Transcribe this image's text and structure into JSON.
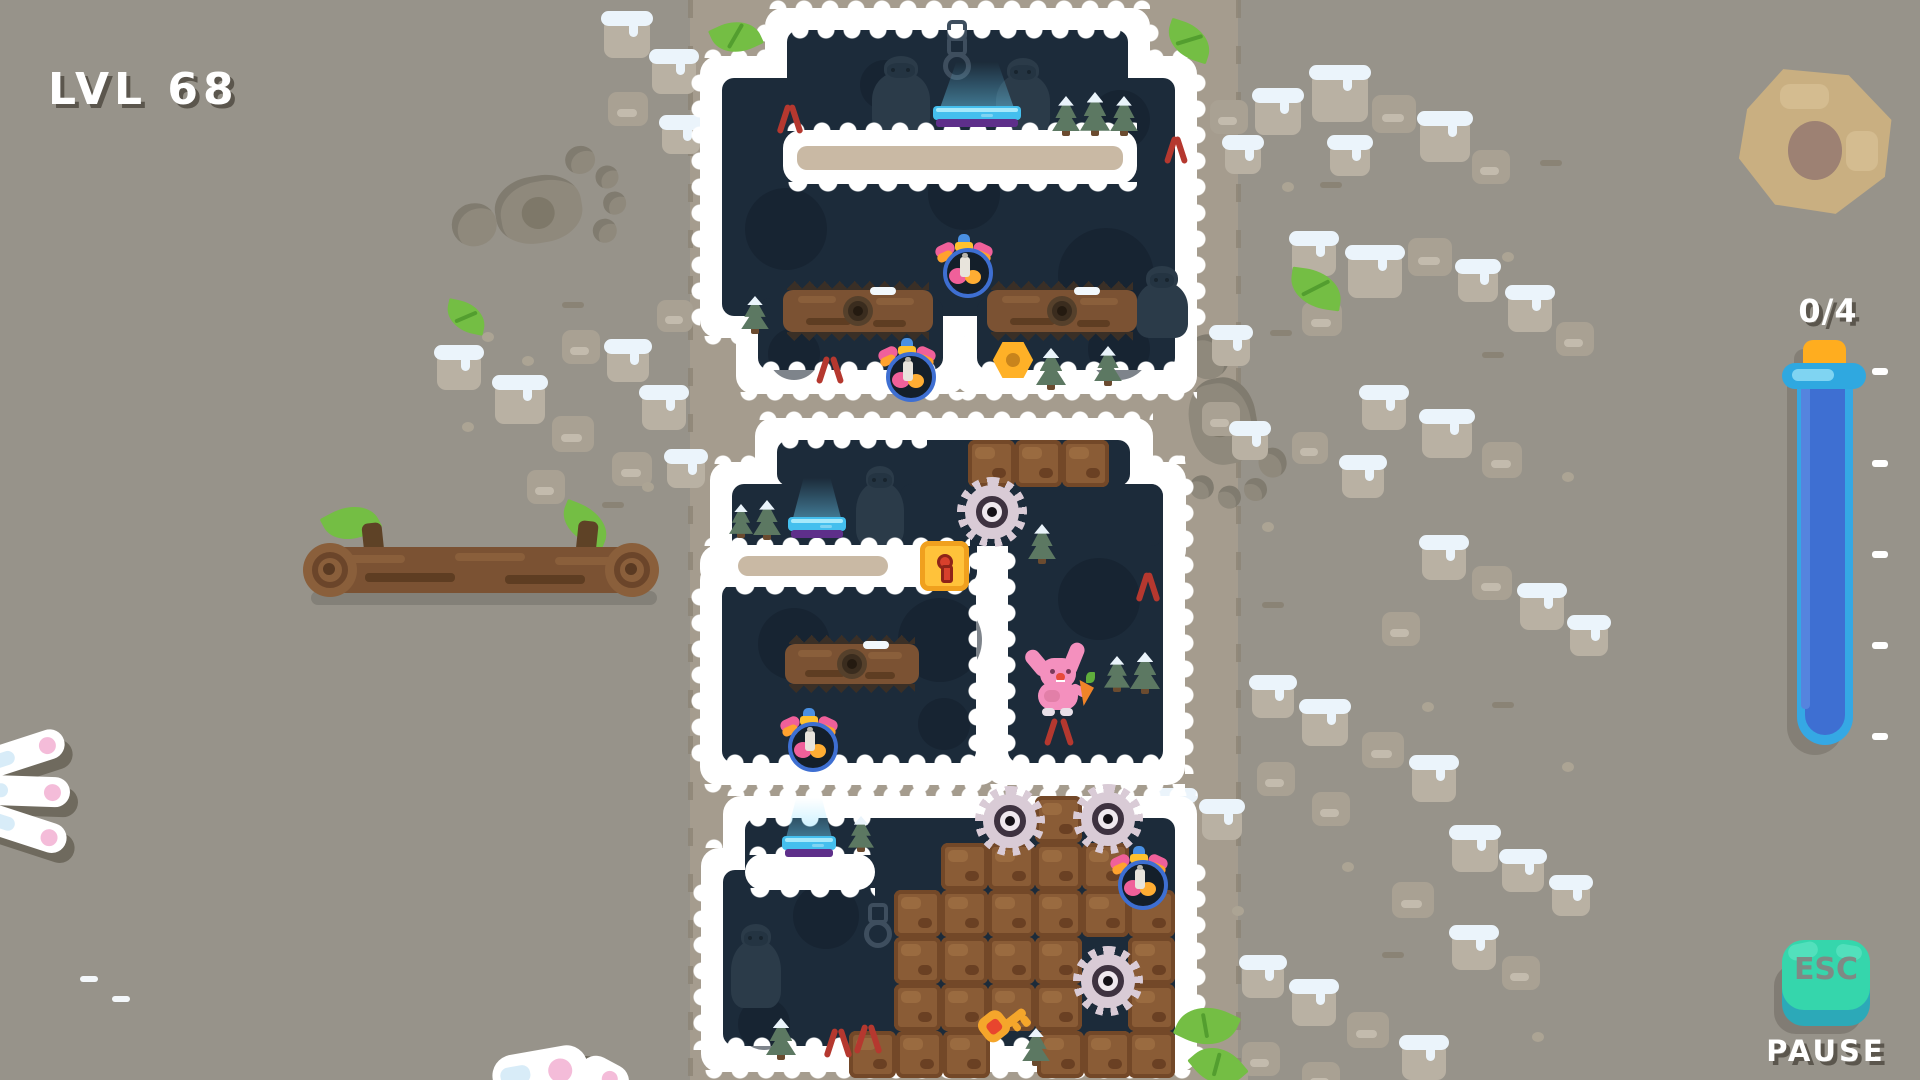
{
  "hud": {
    "level_label": "LVL 68",
    "counter": "0/4",
    "esc_label": "ESC",
    "pause_label": "PAUSE",
    "tube_ticks": [
      368,
      460,
      551,
      642,
      733
    ]
  },
  "colors": {
    "background": "#97938a",
    "path": "#a59c8e",
    "cave": "#1c2b3a",
    "snow_border": "#ffffff",
    "tube_fill": "#3e6fd2",
    "tube_glass": "#35a8e4",
    "tube_cap": "#ffad1f",
    "esc_button": "#35d6ac",
    "esc_side": "#2ca9b8",
    "crate": "#8a5c36",
    "saw": "#d9cbd6",
    "lock": "#ffc23a",
    "key": "#f5a62b",
    "bunny": "#f490be",
    "carrot": "#f08428",
    "leaf": "#74be44",
    "pad": "#44bfee",
    "pad_base": "#5e2f8a"
  },
  "scene": {
    "path": {
      "x": 690,
      "w": 548
    },
    "white_pieces": [
      [
        765,
        8,
        385,
        144
      ],
      [
        700,
        56,
        497,
        282
      ],
      [
        736,
        276,
        229,
        118
      ],
      [
        955,
        276,
        242,
        118
      ],
      [
        755,
        418,
        398,
        90
      ],
      [
        710,
        462,
        289,
        146
      ],
      [
        700,
        562,
        298,
        223
      ],
      [
        986,
        462,
        199,
        323
      ],
      [
        878,
        462,
        308,
        106
      ],
      [
        723,
        796,
        474,
        136
      ],
      [
        701,
        848,
        496,
        224
      ]
    ],
    "navy_pieces": [
      [
        787,
        30,
        341,
        100
      ],
      [
        722,
        78,
        453,
        238
      ],
      [
        758,
        298,
        185,
        72
      ],
      [
        977,
        298,
        198,
        72
      ],
      [
        777,
        440,
        353,
        46
      ],
      [
        732,
        484,
        245,
        100
      ],
      [
        722,
        584,
        254,
        179
      ],
      [
        1008,
        484,
        155,
        279
      ],
      [
        900,
        484,
        263,
        62
      ],
      [
        745,
        818,
        430,
        92
      ],
      [
        723,
        870,
        452,
        176
      ]
    ],
    "outer_bumps": [
      [
        765,
        -4,
        385,
        "top"
      ],
      [
        700,
        45,
        497,
        "top"
      ],
      [
        736,
        392,
        229,
        "bottom"
      ],
      [
        955,
        392,
        242,
        "bottom"
      ],
      [
        700,
        336,
        497,
        "bottom"
      ],
      [
        688,
        70,
        260,
        "left"
      ],
      [
        1197,
        70,
        260,
        "right"
      ],
      [
        753,
        20,
        120,
        "left"
      ],
      [
        1150,
        20,
        120,
        "right"
      ],
      [
        755,
        407,
        398,
        "top"
      ],
      [
        710,
        451,
        289,
        "top"
      ],
      [
        700,
        550,
        298,
        "top"
      ],
      [
        986,
        451,
        199,
        "top"
      ],
      [
        878,
        451,
        308,
        "top"
      ],
      [
        700,
        784,
        298,
        "bottom"
      ],
      [
        986,
        784,
        199,
        "bottom"
      ],
      [
        688,
        584,
        180,
        "left"
      ],
      [
        1185,
        474,
        300,
        "right"
      ],
      [
        723,
        783,
        474,
        "top"
      ],
      [
        701,
        835,
        496,
        "top"
      ],
      [
        701,
        1070,
        496,
        "bottom"
      ],
      [
        690,
        880,
        170,
        "left"
      ],
      [
        1197,
        860,
        200,
        "right"
      ]
    ],
    "inner_bumps": [
      [
        787,
        30,
        341,
        "bottom"
      ],
      [
        758,
        357,
        185,
        "top"
      ],
      [
        977,
        357,
        198,
        "top"
      ],
      [
        777,
        440,
        150,
        "bottom"
      ],
      [
        722,
        750,
        254,
        "top"
      ],
      [
        1008,
        750,
        155,
        "top"
      ],
      [
        965,
        548,
        215,
        "left"
      ],
      [
        1007,
        548,
        215,
        "right"
      ],
      [
        745,
        818,
        130,
        "bottom"
      ],
      [
        723,
        1033,
        452,
        "top"
      ]
    ],
    "platforms": [
      {
        "x": 783,
        "y": 130,
        "w": 354,
        "h": 54,
        "core": [
          797,
          146,
          326,
          24
        ]
      },
      {
        "x": 700,
        "y": 545,
        "w": 270,
        "h": 42,
        "core": [
          738,
          556,
          150,
          20
        ]
      },
      {
        "x": 745,
        "y": 854,
        "w": 130,
        "h": 36,
        "core": null
      }
    ],
    "platform_bumps": [
      [
        783,
        118,
        354,
        "top"
      ],
      [
        783,
        182,
        354,
        "drip"
      ],
      [
        700,
        533,
        270,
        "top"
      ],
      [
        700,
        585,
        270,
        "drip"
      ],
      [
        745,
        842,
        130,
        "top"
      ],
      [
        745,
        888,
        130,
        "drip"
      ]
    ],
    "blobs": [
      [
        745,
        188,
        82
      ],
      [
        928,
        158,
        72
      ],
      [
        1058,
        228,
        96
      ],
      [
        768,
        328,
        52
      ],
      [
        1088,
        318,
        62
      ],
      [
        758,
        608,
        72
      ],
      [
        898,
        598,
        84
      ],
      [
        1058,
        558,
        82
      ],
      [
        918,
        698,
        52
      ],
      [
        793,
        883,
        66
      ],
      [
        738,
        998,
        52
      ],
      [
        860,
        60,
        50
      ],
      [
        1090,
        90,
        60
      ]
    ],
    "yetis": [
      [
        872,
        56,
        58,
        78
      ],
      [
        996,
        58,
        54,
        76
      ],
      [
        1136,
        266,
        52,
        72
      ],
      [
        856,
        466,
        48,
        80
      ],
      [
        731,
        924,
        50,
        84
      ]
    ],
    "chains": [
      [
        947,
        20,
        36
      ],
      [
        868,
        903,
        28
      ]
    ],
    "pads": [
      [
        933,
        106,
        88
      ],
      [
        788,
        517,
        58
      ],
      [
        782,
        836,
        54
      ]
    ],
    "glows": [
      [
        940,
        62,
        74,
        46
      ],
      [
        793,
        478,
        48,
        40
      ],
      [
        786,
        798,
        46,
        40
      ]
    ],
    "spike_logs": [
      [
        783,
        290,
        150,
        42
      ],
      [
        987,
        290,
        150,
        42
      ],
      [
        785,
        644,
        134,
        40
      ]
    ],
    "crates": [
      [
        968,
        440
      ],
      [
        1015,
        440
      ],
      [
        1062,
        440
      ],
      [
        1035,
        796
      ],
      [
        941,
        843
      ],
      [
        988,
        843
      ],
      [
        1035,
        843
      ],
      [
        1082,
        843
      ],
      [
        894,
        890
      ],
      [
        941,
        890
      ],
      [
        988,
        890
      ],
      [
        1035,
        890
      ],
      [
        1082,
        890
      ],
      [
        1128,
        890
      ],
      [
        894,
        937
      ],
      [
        941,
        937
      ],
      [
        988,
        937
      ],
      [
        1035,
        937
      ],
      [
        1128,
        937
      ],
      [
        894,
        984
      ],
      [
        941,
        984
      ],
      [
        988,
        984
      ],
      [
        1035,
        984
      ],
      [
        1128,
        984
      ],
      [
        849,
        1031
      ],
      [
        896,
        1031
      ],
      [
        943,
        1031
      ],
      [
        1037,
        1031
      ],
      [
        1084,
        1031
      ],
      [
        1128,
        1031
      ]
    ],
    "saws": [
      [
        992,
        512,
        27
      ],
      [
        1010,
        821,
        27
      ],
      [
        1108,
        819,
        27
      ],
      [
        1108,
        981,
        27
      ]
    ],
    "lock": [
      920,
      541,
      49,
      50
    ],
    "key": [
      983,
      1003,
      -38
    ],
    "nut": [
      992,
      340
    ],
    "potions": [
      [
        941,
        234
      ],
      [
        884,
        338
      ],
      [
        786,
        708
      ],
      [
        1116,
        846
      ]
    ],
    "bunny": [
      1026,
      650
    ],
    "pines": [
      [
        1052,
        96,
        28,
        40
      ],
      [
        1080,
        92,
        30,
        44
      ],
      [
        1110,
        96,
        28,
        40
      ],
      [
        741,
        296,
        28,
        38
      ],
      [
        1036,
        348,
        30,
        42
      ],
      [
        1094,
        346,
        28,
        40
      ],
      [
        729,
        504,
        24,
        34
      ],
      [
        753,
        500,
        28,
        40
      ],
      [
        1104,
        656,
        26,
        36
      ],
      [
        1130,
        652,
        30,
        42
      ],
      [
        1028,
        524,
        28,
        40
      ],
      [
        848,
        816,
        26,
        36
      ],
      [
        766,
        1018,
        30,
        42
      ],
      [
        1022,
        1028,
        28,
        38
      ]
    ],
    "claws": [
      [
        779,
        104,
        22,
        30
      ],
      [
        1166,
        136,
        20,
        28
      ],
      [
        818,
        356,
        24,
        28
      ],
      [
        1046,
        718,
        26,
        28
      ],
      [
        1138,
        572,
        20,
        30
      ],
      [
        826,
        1028,
        24,
        30
      ],
      [
        856,
        1024,
        24,
        30
      ]
    ],
    "leaves": [
      [
        713,
        20,
        46,
        34,
        -25
      ],
      [
        1166,
        24,
        46,
        34,
        18
      ],
      [
        1290,
        270,
        52,
        38,
        8
      ],
      [
        1186,
        998,
        42,
        56,
        -65
      ],
      [
        1198,
        1042,
        40,
        48,
        -40
      ],
      [
        446,
        302,
        40,
        30,
        12
      ]
    ],
    "rocks": [
      [
        1255,
        95,
        46,
        40,
        1
      ],
      [
        1312,
        72,
        56,
        50,
        1
      ],
      [
        1372,
        95,
        44,
        38,
        0
      ],
      [
        1330,
        142,
        40,
        34,
        1
      ],
      [
        1420,
        118,
        50,
        44,
        1
      ],
      [
        1472,
        150,
        38,
        34,
        0
      ],
      [
        1292,
        238,
        44,
        38,
        1
      ],
      [
        1348,
        252,
        54,
        46,
        1
      ],
      [
        1408,
        238,
        44,
        38,
        0
      ],
      [
        1458,
        266,
        40,
        36,
        1
      ],
      [
        1508,
        292,
        44,
        40,
        1
      ],
      [
        1556,
        322,
        38,
        34,
        0
      ],
      [
        1302,
        302,
        40,
        34,
        0
      ],
      [
        1362,
        392,
        44,
        38,
        1
      ],
      [
        1422,
        416,
        50,
        42,
        1
      ],
      [
        1482,
        442,
        40,
        36,
        0
      ],
      [
        1342,
        462,
        42,
        36,
        1
      ],
      [
        1292,
        432,
        36,
        32,
        0
      ],
      [
        1422,
        542,
        44,
        38,
        1
      ],
      [
        1472,
        566,
        40,
        34,
        0
      ],
      [
        1520,
        590,
        44,
        40,
        1
      ],
      [
        1382,
        612,
        38,
        34,
        0
      ],
      [
        1570,
        622,
        38,
        34,
        1
      ],
      [
        1252,
        682,
        42,
        36,
        1
      ],
      [
        1302,
        706,
        46,
        40,
        1
      ],
      [
        1362,
        732,
        42,
        36,
        0
      ],
      [
        1257,
        762,
        38,
        34,
        0
      ],
      [
        1412,
        762,
        44,
        40,
        1
      ],
      [
        1312,
        792,
        38,
        34,
        0
      ],
      [
        1452,
        832,
        46,
        40,
        1
      ],
      [
        1502,
        856,
        42,
        36,
        1
      ],
      [
        1392,
        882,
        42,
        36,
        0
      ],
      [
        1552,
        882,
        38,
        34,
        1
      ],
      [
        1452,
        932,
        44,
        38,
        1
      ],
      [
        1502,
        956,
        38,
        34,
        0
      ],
      [
        1242,
        962,
        42,
        36,
        1
      ],
      [
        1292,
        986,
        44,
        40,
        1
      ],
      [
        1347,
        1012,
        42,
        36,
        0
      ],
      [
        1242,
        1042,
        38,
        34,
        0
      ],
      [
        1402,
        1042,
        44,
        38,
        1
      ],
      [
        1302,
        1062,
        38,
        32,
        0
      ],
      [
        437,
        352,
        44,
        38,
        1
      ],
      [
        495,
        382,
        50,
        42,
        1
      ],
      [
        552,
        416,
        42,
        36,
        0
      ],
      [
        607,
        346,
        42,
        36,
        1
      ],
      [
        562,
        330,
        38,
        34,
        0
      ],
      [
        642,
        392,
        44,
        38,
        1
      ],
      [
        612,
        452,
        40,
        34,
        0
      ],
      [
        667,
        456,
        38,
        32,
        1
      ],
      [
        527,
        470,
        38,
        34,
        0
      ],
      [
        657,
        300,
        36,
        32,
        0
      ],
      [
        604,
        18,
        46,
        40,
        1
      ],
      [
        652,
        56,
        44,
        38,
        1
      ],
      [
        608,
        92,
        40,
        34,
        0
      ],
      [
        662,
        122,
        38,
        32,
        1
      ],
      [
        1210,
        100,
        38,
        34,
        0
      ],
      [
        1225,
        142,
        36,
        32,
        1
      ],
      [
        1212,
        332,
        38,
        34,
        1
      ],
      [
        1202,
        402,
        38,
        34,
        0
      ],
      [
        1232,
        428,
        36,
        32,
        1
      ],
      [
        1157,
        795,
        38,
        32,
        1
      ],
      [
        1202,
        806,
        40,
        34,
        1
      ],
      [
        1210,
        1062,
        38,
        30,
        0
      ]
    ],
    "pebbles": [
      [
        482,
        332
      ],
      [
        522,
        356
      ],
      [
        700,
        142
      ],
      [
        1282,
        182
      ],
      [
        1502,
        252
      ],
      [
        1562,
        472
      ],
      [
        1422,
        702
      ],
      [
        1342,
        862
      ],
      [
        1562,
        762
      ],
      [
        462,
        422
      ],
      [
        642,
        482
      ],
      [
        1262,
        522
      ],
      [
        1232,
        906
      ],
      [
        1532,
        1032
      ],
      [
        1180,
        60
      ],
      [
        560,
        560
      ]
    ],
    "ground_dashes": [
      [
        1320,
        182,
        0
      ],
      [
        1482,
        352,
        0
      ],
      [
        1262,
        602,
        0
      ],
      [
        1492,
        702,
        0
      ],
      [
        1382,
        952,
        0
      ],
      [
        562,
        302,
        0
      ],
      [
        602,
        502,
        0
      ],
      [
        1540,
        160,
        0
      ],
      [
        1270,
        330,
        0
      ]
    ],
    "white_dashes": [
      [
        80,
        976
      ],
      [
        112,
        996
      ]
    ],
    "footprints": [
      [
        480,
        160,
        150,
        95,
        -10
      ],
      [
        1150,
        390,
        150,
        95,
        80
      ]
    ],
    "log_big": {
      "x": 305,
      "y": 505
    },
    "bg_nut": {
      "x": 1734,
      "y": 66,
      "w": 164,
      "h": 154
    },
    "paw": {
      "x": -14,
      "y": 728
    },
    "ears": {
      "x": 492,
      "y": 1044
    }
  }
}
